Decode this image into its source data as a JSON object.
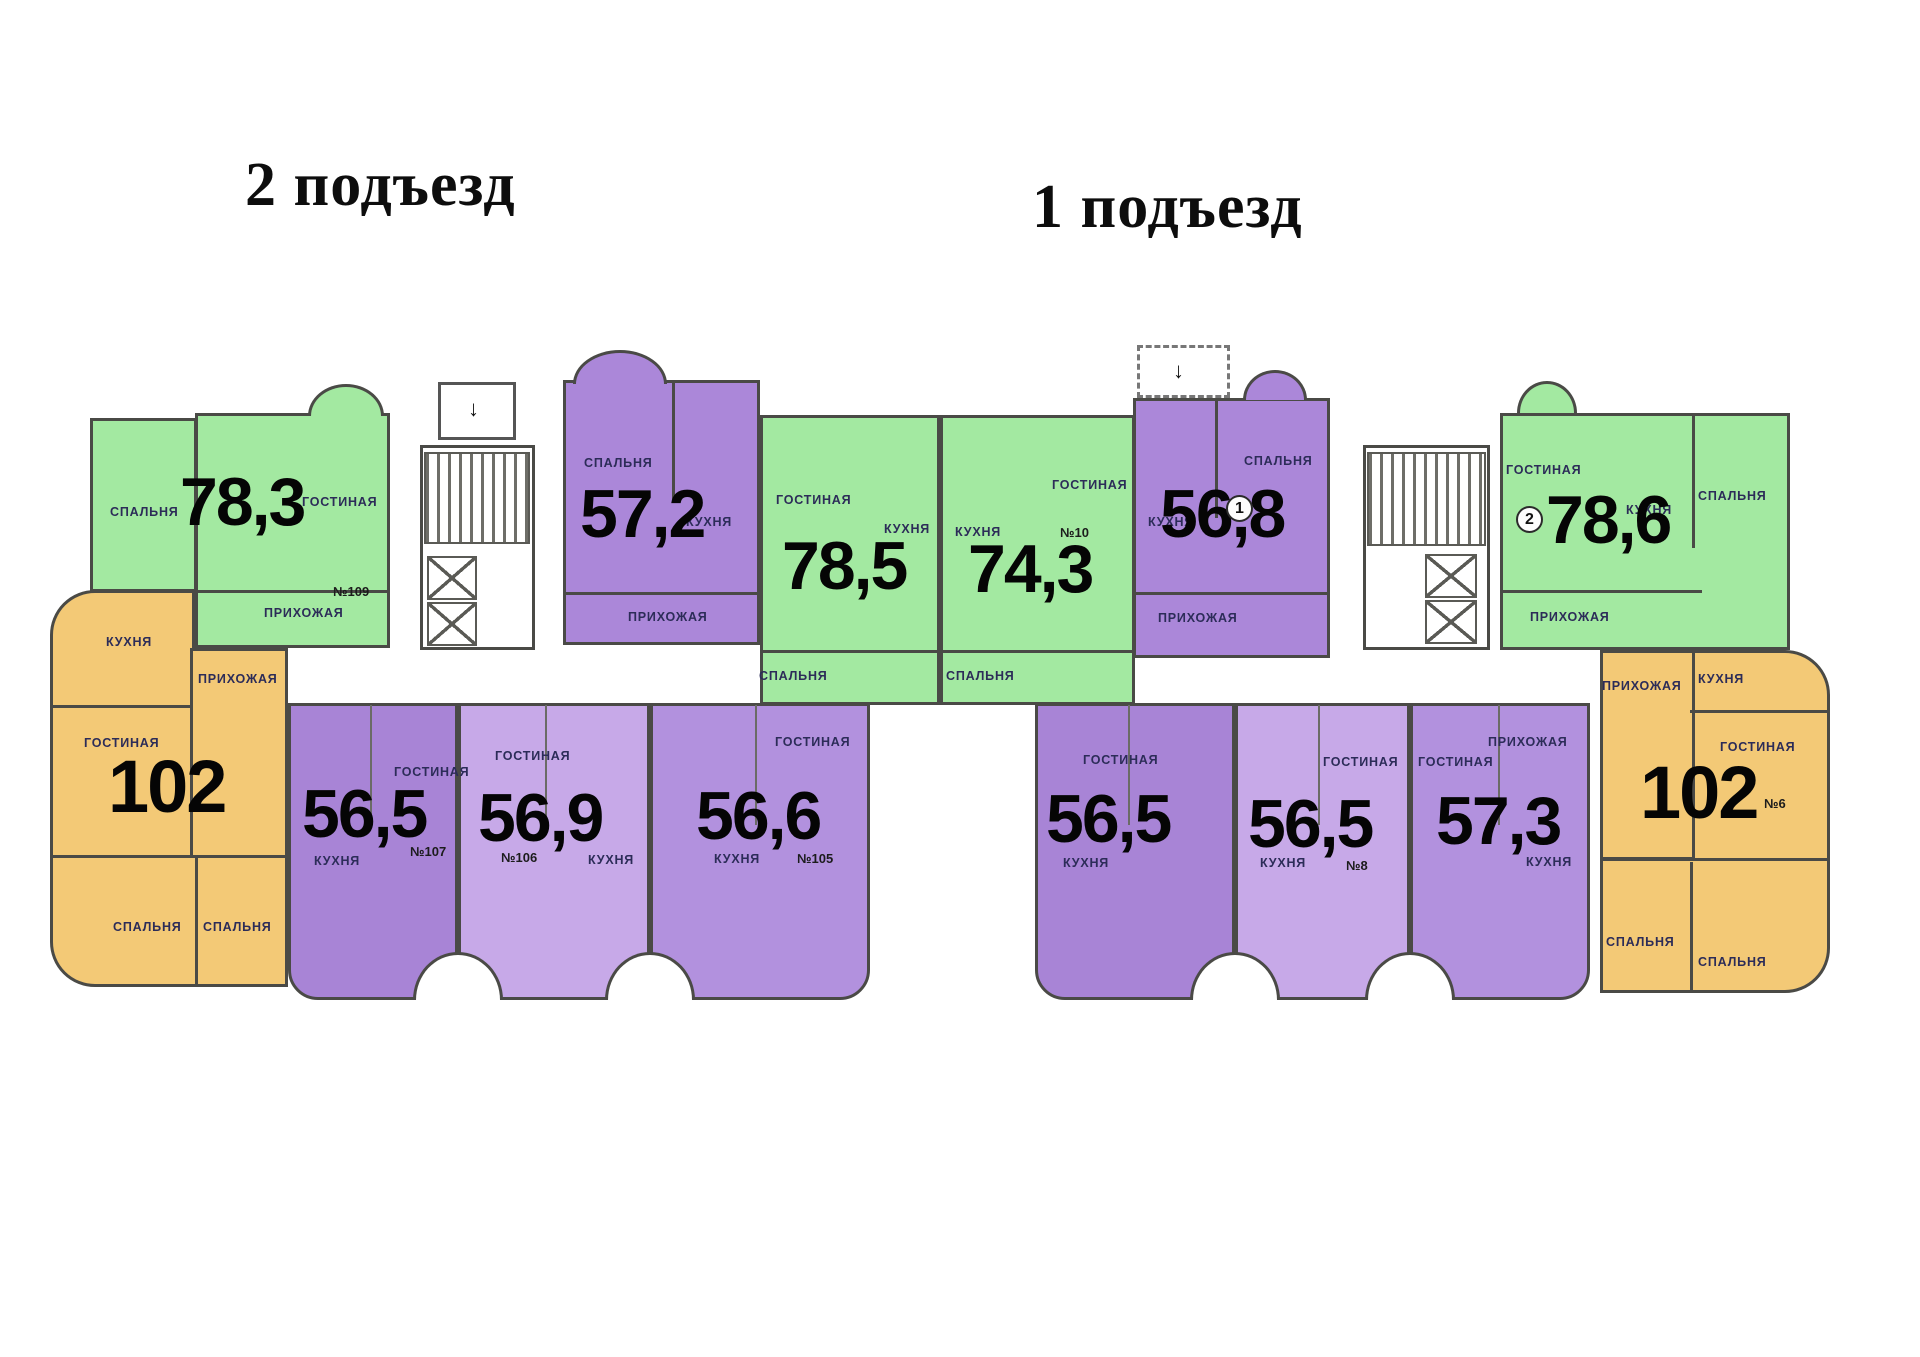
{
  "headers": {
    "entrance2": "2 подъезд",
    "entrance1": "1 подъезд"
  },
  "icons": {
    "entrance_arrow": "↓"
  },
  "colors": {
    "green": "#a3e9a1",
    "purple": "#ab87d9",
    "purple_dark": "#a884d6",
    "purple_light": "#c7a9e8",
    "purple_mid": "#b291de",
    "orange": "#f3c976",
    "wall": "#4a4a46",
    "room_label": "#2c2c58",
    "area_text": "#050505"
  },
  "apartments": {
    "apt_102_left": {
      "area": "102",
      "rooms": {
        "kitchen": "КУХНЯ",
        "hallway": "ПРИХОЖАЯ",
        "living": "ГОСТИНАЯ",
        "bedroom1": "СПАЛЬНЯ",
        "bedroom2": "СПАЛЬНЯ"
      }
    },
    "apt_78_3": {
      "area": "78,3",
      "number": "№109",
      "rooms": {
        "bedroom": "СПАЛЬНЯ",
        "living": "ГОСТИНАЯ",
        "hallway": "ПРИХОЖАЯ"
      }
    },
    "apt_57_2": {
      "area": "57,2",
      "rooms": {
        "bedroom": "СПАЛЬНЯ",
        "kitchen": "КУХНЯ",
        "hallway": "ПРИХОЖАЯ"
      }
    },
    "apt_78_5": {
      "area": "78,5",
      "rooms": {
        "living": "ГОСТИНАЯ",
        "kitchen": "КУХНЯ",
        "bedroom": "СПАЛЬНЯ"
      }
    },
    "apt_74_3": {
      "area": "74,3",
      "number": "№10",
      "rooms": {
        "living": "ГОСТИНАЯ",
        "kitchen": "КУХНЯ",
        "bedroom": "СПАЛЬНЯ"
      }
    },
    "apt_56_5_left": {
      "area": "56,5",
      "number": "№107",
      "rooms": {
        "living": "ГОСТИНАЯ",
        "kitchen": "КУХНЯ"
      }
    },
    "apt_56_9": {
      "area": "56,9",
      "number": "№106",
      "rooms": {
        "living": "ГОСТИНАЯ",
        "kitchen": "КУХНЯ"
      }
    },
    "apt_56_6": {
      "area": "56,6",
      "number": "№105",
      "rooms": {
        "living": "ГОСТИНАЯ",
        "kitchen": "КУХНЯ"
      }
    },
    "apt_56_8": {
      "area": "56,8",
      "unit_mark": "1",
      "rooms": {
        "bedroom": "СПАЛЬНЯ",
        "kitchen": "КУХНЯ",
        "hallway": "ПРИХОЖАЯ"
      }
    },
    "apt_78_6": {
      "area": "78,6",
      "unit_mark": "2",
      "rooms": {
        "living": "ГОСТИНАЯ",
        "kitchen": "КУХНЯ",
        "bedroom": "СПАЛЬНЯ",
        "hallway": "ПРИХОЖАЯ"
      }
    },
    "apt_102_right": {
      "area": "102",
      "number": "№6",
      "rooms": {
        "kitchen": "КУХНЯ",
        "hallway": "ПРИХОЖАЯ",
        "living": "ГОСТИНАЯ",
        "bedroom1": "СПАЛЬНЯ",
        "bedroom2": "СПАЛЬНЯ"
      }
    },
    "apt_56_5_r1": {
      "area": "56,5",
      "rooms": {
        "living": "ГОСТИНАЯ",
        "kitchen": "КУХНЯ"
      }
    },
    "apt_56_5_r2": {
      "area": "56,5",
      "number": "№8",
      "rooms": {
        "living": "ГОСТИНАЯ",
        "kitchen": "КУХНЯ"
      }
    },
    "apt_57_3": {
      "area": "57,3",
      "rooms": {
        "living": "ГОСТИНАЯ",
        "kitchen": "КУХНЯ",
        "hallway": "ПРИХОЖАЯ"
      }
    }
  }
}
